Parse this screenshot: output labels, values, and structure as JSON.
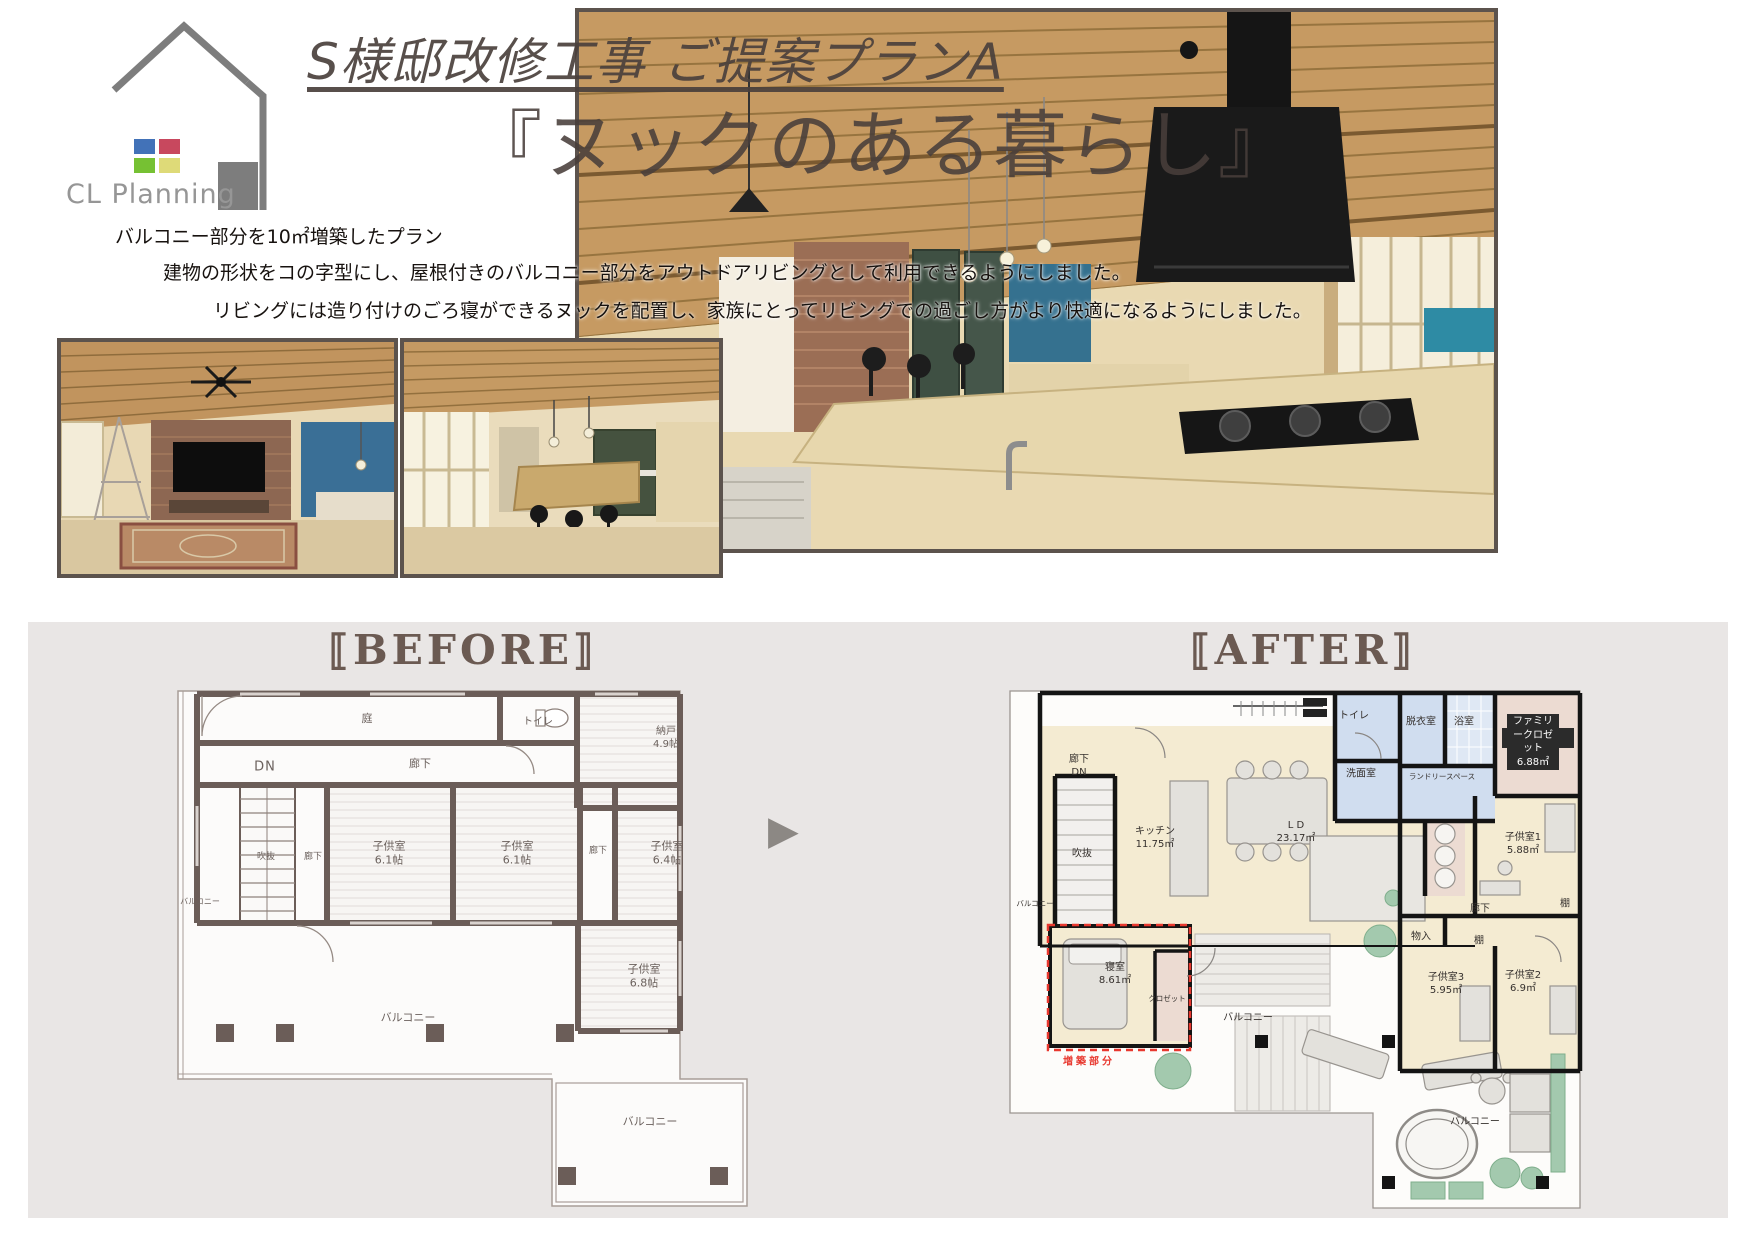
{
  "logo": {
    "company": "CL Planning"
  },
  "header": {
    "title": "S様邸改修工事 ご提案プランA",
    "subtitle": "『ヌックのある暮らし』"
  },
  "description": {
    "line1": "バルコニー部分を10㎡増築したプラン",
    "line2": "建物の形状をコの字型にし、屋根付きのバルコニー部分をアウトドアリビングとして利用できるようにしました。",
    "line3": "リビングには造り付けのごろ寝ができるヌックを配置し、家族にとってリビングでの過ごし方がより快適になるようにしました。"
  },
  "comparison": {
    "before_label": "⟦BEFORE⟧",
    "after_label": "⟦AFTER⟧",
    "arrow": "▶",
    "before_rooms": {
      "garden": "庭",
      "toilet": "トイレ",
      "storage": "納戸\n4.9帖",
      "dn": "DN",
      "hall_top": "廊下",
      "void": "吹抜",
      "hall_left": "廊下",
      "kids1": "子供室\n6.1帖",
      "kids2": "子供室\n6.1帖",
      "hall_right": "廊下",
      "kids3": "子供室\n6.4帖",
      "kids4": "子供室\n6.8帖",
      "balcony_left": "バルコニー",
      "balcony_center": "バルコニー",
      "balcony_bottom": "バルコニー"
    },
    "after_rooms": {
      "hall_dn": "廊下\nDN",
      "kitchen": "キッチン\n11.75㎡",
      "ld": "L D\n23.17㎡",
      "toilet": "トイレ",
      "dressing": "脱衣室",
      "bath": "浴室",
      "washroom": "洗面室",
      "laundry": "ランドリースペース",
      "family_closet": "ファミリークロゼット\n6.88㎡",
      "kids1": "子供室1\n5.88㎡",
      "hall": "廊下",
      "storage": "物入",
      "shelf1": "棚",
      "shelf2": "棚",
      "kids3": "子供室3\n5.95㎡",
      "kids2": "子供室2\n6.9㎡",
      "void": "吹抜",
      "balcony_left": "バルコニー",
      "bedroom": "寝室\n8.61㎡",
      "closet": "クロゼット",
      "balcony_deck": "バルコニー",
      "balcony_lower": "バルコニー",
      "annotation": "増築部分"
    }
  },
  "colors": {
    "accent_red": "#e8382f",
    "panel_bg": "#e9e6e5",
    "before_wall": "#6b5d58",
    "after_wall": "#141414",
    "heading_brown": "#6b5a52",
    "logo_blue": "#4272b8",
    "logo_red": "#c8485e",
    "logo_green": "#76c133",
    "logo_yellow": "#deda78",
    "logo_gray": "#969696"
  }
}
